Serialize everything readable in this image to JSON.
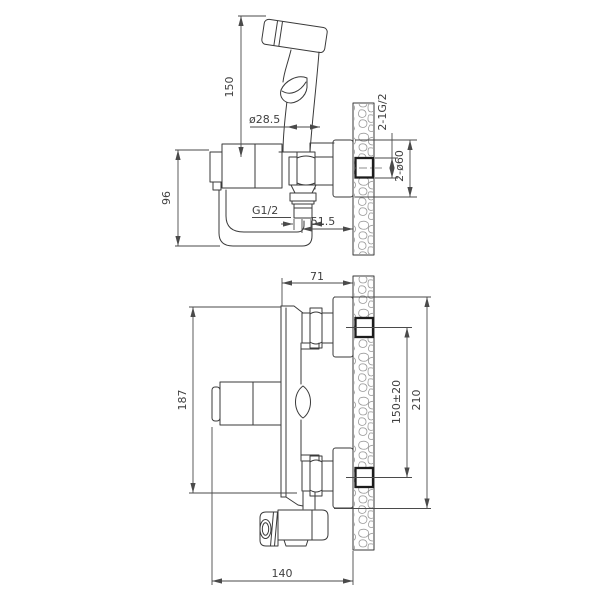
{
  "drawing": {
    "side_view": {
      "sprayer_height": "150",
      "sprayer_diameter": "ø28.5",
      "body_height": "96",
      "outlet_thread": "G1/2",
      "outlet_to_wall": "51.5",
      "wall_connections_thread": "2-1G/2",
      "wall_flange_diameter": "2-ø60"
    },
    "install_view": {
      "projection": "71",
      "body_length": "187",
      "connection_spacing": "150±20",
      "flange_outer_span": "210",
      "overall_depth": "140"
    },
    "colors": {
      "line": "#3a3a3a",
      "dimension": "#4a4a4a",
      "wall_hatch": "#9a9a9a"
    }
  }
}
